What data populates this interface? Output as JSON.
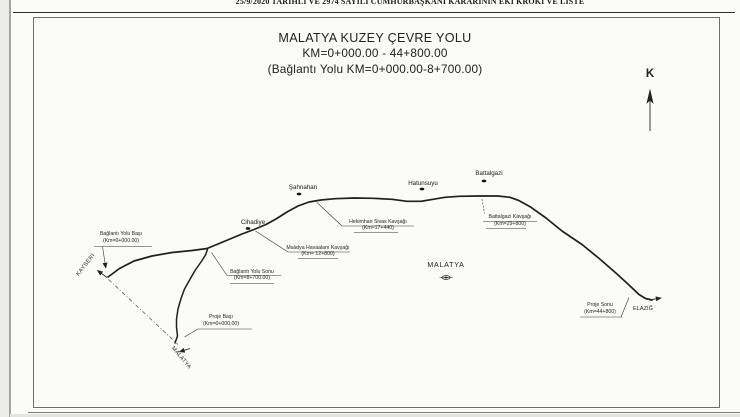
{
  "document": {
    "header": "25/9/2020 TARİHLİ VE 2974 SAYILI CUMHURBAŞKANI KARARININ EKİ KROKİ VE LİSTE"
  },
  "map": {
    "title": "MALATYA KUZEY ÇEVRE YOLU",
    "km_range": "KM=0+000.00 - 44+800.00",
    "subtitle": "(Bağlantı Yolu KM=0+000.00-8+700.00)",
    "north_label": "K",
    "city_label": "MALATYA",
    "directions": {
      "kayseri": "KAYSERİ",
      "malatya": "MALATYA",
      "elazig": "ELAZIĞ"
    },
    "settlements": [
      {
        "name": "Cihadiye"
      },
      {
        "name": "Şahnahan"
      },
      {
        "name": "Hatunsuyu"
      },
      {
        "name": "Battalgazi"
      }
    ],
    "waypoints": [
      {
        "name": "Bağlantı Yolu Başı",
        "km": "(Km=0+000.00)"
      },
      {
        "name": "Bağlantı Yolu Sonu",
        "km": "(Km=8+700.00)"
      },
      {
        "name": "Malatya Havaalanı Kavşağı",
        "km": "(Km= 12+800)"
      },
      {
        "name": "Hekimhan Sivas Kavşağı",
        "km": "(Km=17+440)"
      },
      {
        "name": "Battalgazi Kavşağı",
        "km": "(Km=29+800)"
      },
      {
        "name": "Proje Başı",
        "km": "(Km=0+000.00)"
      },
      {
        "name": "Proje Sonu",
        "km": "(Km=44+800)"
      }
    ]
  }
}
